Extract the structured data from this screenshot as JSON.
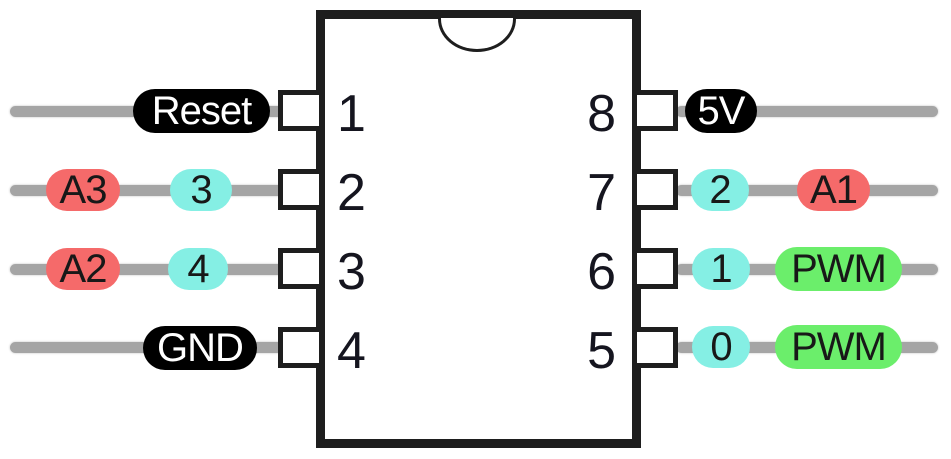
{
  "diagram": {
    "title": "8-pin IC pinout",
    "ic": {
      "package": "DIP-8",
      "notch": "top-center half-circle"
    },
    "left_pins": [
      {
        "number": "1",
        "labels": [
          {
            "text": "Reset",
            "style": "black"
          }
        ]
      },
      {
        "number": "2",
        "labels": [
          {
            "text": "A3",
            "style": "red"
          },
          {
            "text": "3",
            "style": "cyan"
          }
        ]
      },
      {
        "number": "3",
        "labels": [
          {
            "text": "A2",
            "style": "red"
          },
          {
            "text": "4",
            "style": "cyan"
          }
        ]
      },
      {
        "number": "4",
        "labels": [
          {
            "text": "GND",
            "style": "black"
          }
        ]
      }
    ],
    "right_pins": [
      {
        "number": "8",
        "labels": [
          {
            "text": "5V",
            "style": "black"
          }
        ]
      },
      {
        "number": "7",
        "labels": [
          {
            "text": "2",
            "style": "cyan"
          },
          {
            "text": "A1",
            "style": "red"
          }
        ]
      },
      {
        "number": "6",
        "labels": [
          {
            "text": "1",
            "style": "cyan"
          },
          {
            "text": "PWM",
            "style": "green"
          }
        ]
      },
      {
        "number": "5",
        "labels": [
          {
            "text": "0",
            "style": "cyan"
          },
          {
            "text": "PWM",
            "style": "green"
          }
        ]
      }
    ],
    "colors": {
      "power_label_bg": "#000000",
      "power_label_text": "#ffffff",
      "analog_label_bg": "#f56a6a",
      "digital_label_bg": "#85efe4",
      "pwm_label_bg": "#6bee6b",
      "wire": "#a5a5a5",
      "ic_border": "#1e1e1e"
    }
  }
}
